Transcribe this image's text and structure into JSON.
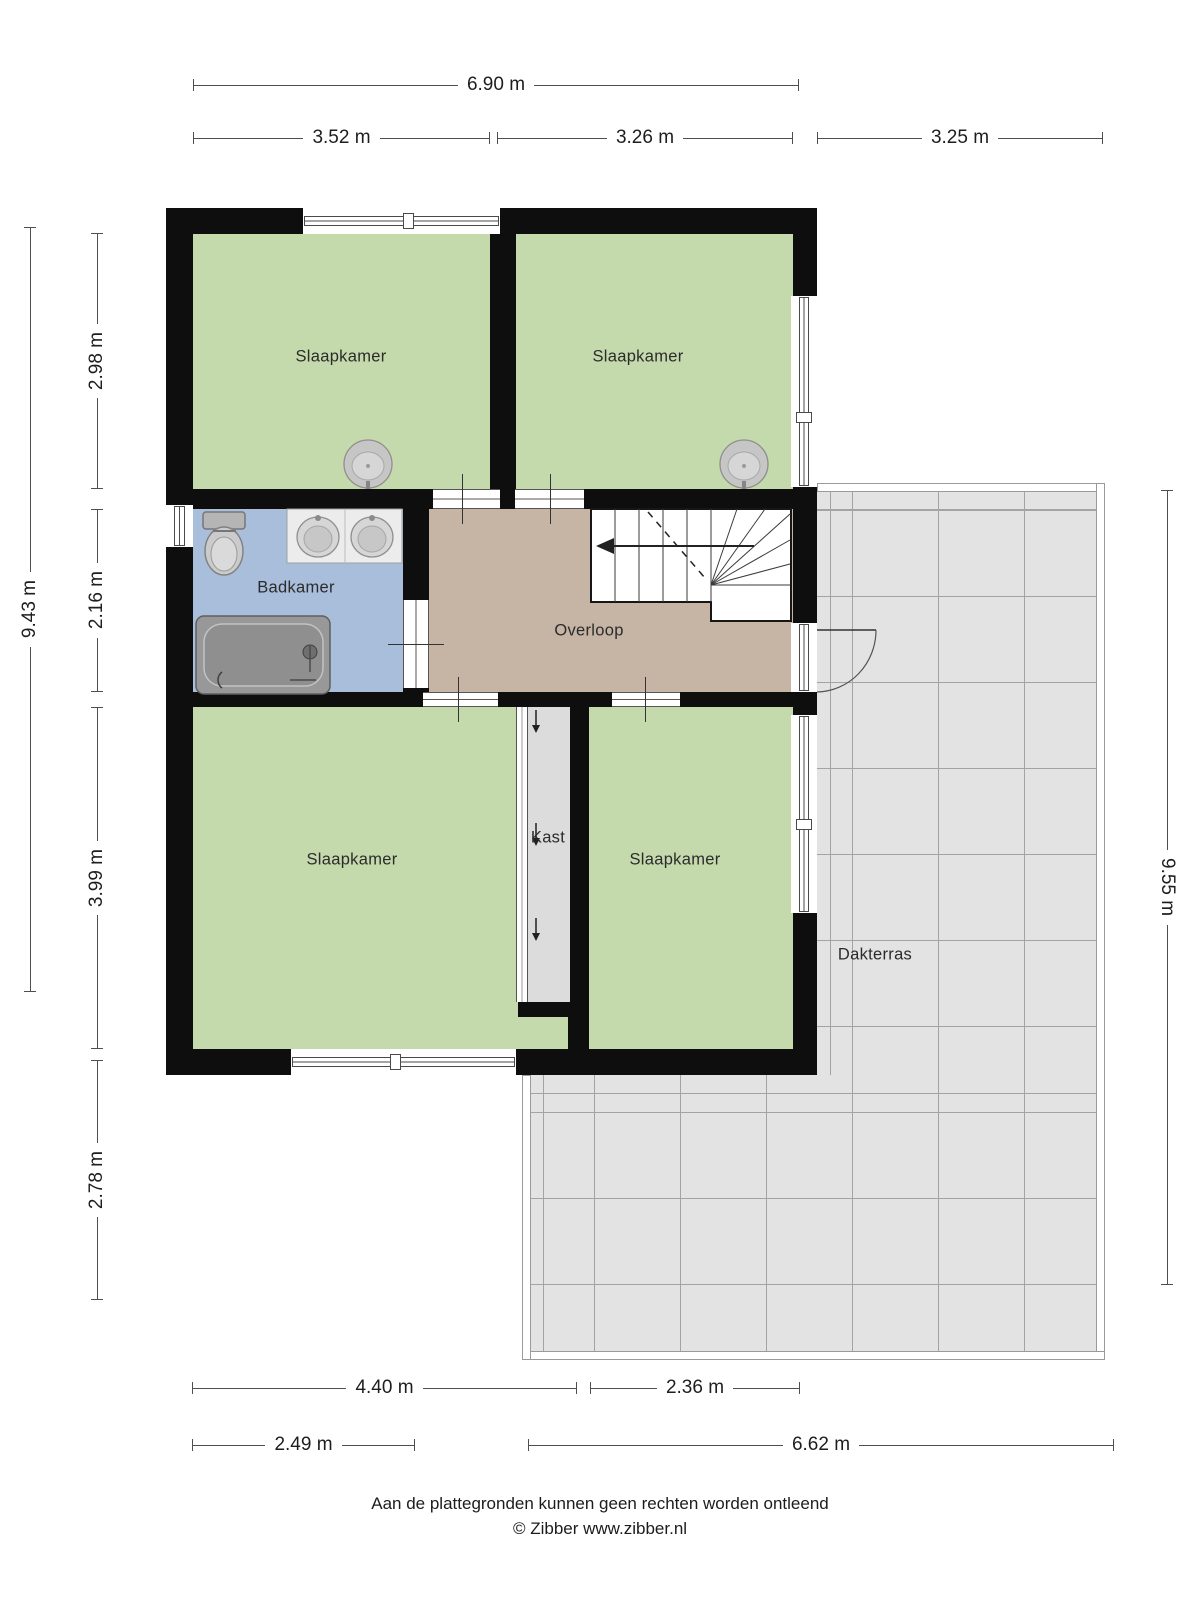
{
  "plan": {
    "rooms": {
      "bedroom_top_left": "Slaapkamer",
      "bedroom_top_right": "Slaapkamer",
      "bathroom": "Badkamer",
      "landing": "Overloop",
      "bedroom_bottom_left": "Slaapkamer",
      "closet": "Kast",
      "bedroom_bottom_right": "Slaapkamer",
      "roof_terrace": "Dakterras"
    },
    "dimensions": {
      "top_total": "6.90 m",
      "top_left": "3.52 m",
      "top_mid": "3.26 m",
      "top_right": "3.25 m",
      "left_total": "9.43 m",
      "left_seg1": "2.98 m",
      "left_seg2": "2.16 m",
      "left_seg3": "3.99 m",
      "left_seg4": "2.78 m",
      "right_total": "9.55 m",
      "bottom_seg1": "4.40 m",
      "bottom_seg2": "2.36 m",
      "bottom_seg3": "2.49 m",
      "bottom_seg4": "6.62 m"
    },
    "colors": {
      "wall": "#0e0e0e",
      "bedroom_floor": "#c5daac",
      "bathroom_floor": "#a9bedb",
      "landing_floor": "#c6b4a4",
      "closet_floor": "#dcdcdc",
      "terrace_tile": "#e3e3e3"
    },
    "footer": {
      "disclaimer": "Aan de plattegronden kunnen geen rechten worden ontleend",
      "credit": "© Zibber www.zibber.nl"
    }
  }
}
